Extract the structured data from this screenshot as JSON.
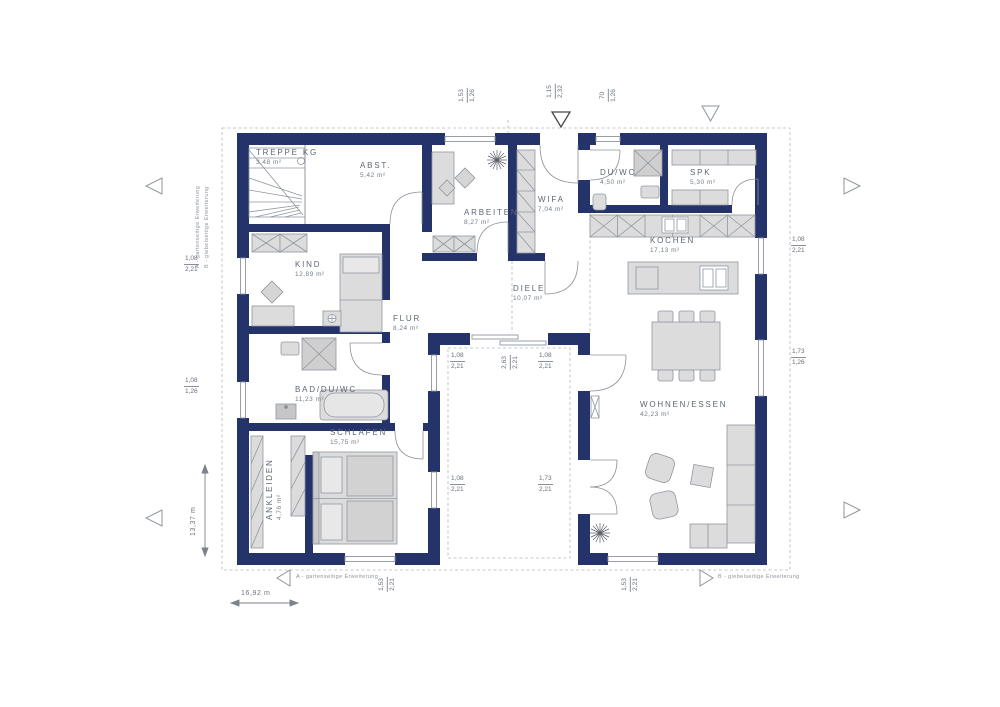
{
  "rooms": {
    "treppe": {
      "name": "TREPPE KG",
      "area": "3,48 m²"
    },
    "abst": {
      "name": "ABST.",
      "area": "5,42 m²"
    },
    "arbeiten": {
      "name": "ARBEITEN",
      "area": "8,27 m²"
    },
    "wifa": {
      "name": "WIFA",
      "area": "7,04 m²"
    },
    "duwc": {
      "name": "DU/WC",
      "area": "4,50 m²"
    },
    "spk": {
      "name": "SPK",
      "area": "5,30 m²"
    },
    "kochen": {
      "name": "KOCHEN",
      "area": "17,13 m²"
    },
    "kind": {
      "name": "KIND",
      "area": "12,89 m²"
    },
    "diele": {
      "name": "DIELE",
      "area": "10,07 m²"
    },
    "flur": {
      "name": "FLUR",
      "area": "8,24 m²"
    },
    "bad": {
      "name": "BAD/DU/WC",
      "area": "11,23 m²"
    },
    "schlafen": {
      "name": "SCHLAFEN",
      "area": "15,75 m²"
    },
    "ankleiden": {
      "name": "ANKLEIDEN",
      "area": "4,76 m²"
    },
    "wohnen": {
      "name": "WOHNEN/ESSEN",
      "area": "42,23 m²"
    }
  },
  "dims": {
    "top1": {
      "a": "1,53",
      "b": "1,26"
    },
    "top2": {
      "a": "1,15",
      "b": "2,32"
    },
    "top3": {
      "a": "70",
      "b": "1,26"
    },
    "right1": {
      "a": "1,08",
      "b": "2,21"
    },
    "right2": {
      "a": "1,73",
      "b": "1,26"
    },
    "left1": {
      "a": "1,08",
      "b": "2,21"
    },
    "left2": {
      "a": "1,08",
      "b": "1,26"
    },
    "ct_tl": {
      "a": "1,08",
      "b": "2,21"
    },
    "ct_mid": {
      "a": "2,63",
      "b": "2,21"
    },
    "ct_tr": {
      "a": "1,08",
      "b": "2,21"
    },
    "ct_bl": {
      "a": "1,08",
      "b": "2,21"
    },
    "ct_br": {
      "a": "1,73",
      "b": "2,21"
    },
    "bottom1": {
      "a": "1,53",
      "b": "2,21"
    },
    "bottom2": {
      "a": "1,53",
      "b": "2,21"
    }
  },
  "totals": {
    "width": "16,92 m",
    "height": "13,37 m"
  },
  "notes": {
    "a": "A - gartenseitige Erweiterung",
    "b": "B - giebelseitige Erweiterung",
    "side_a": "A - gartenseitige Erweiterung",
    "side_b": "B - giebelseitige Erweiterung"
  },
  "colors": {
    "wall": "#24336a",
    "furniture": "#dcdcdc",
    "line": "#8f959e",
    "text": "#5c6673"
  }
}
